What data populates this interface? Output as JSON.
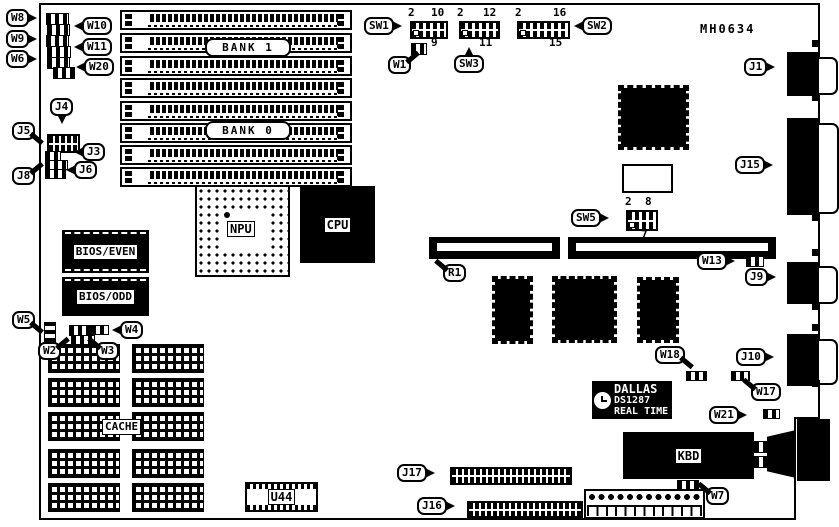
{
  "board": {
    "part_number": "MH0634",
    "ink": "#000000",
    "paper": "#ffffff"
  },
  "callouts": {
    "w8": "W8",
    "w9": "W9",
    "w6": "W6",
    "w10": "W10",
    "w11": "W11",
    "w20": "W20",
    "j4": "J4",
    "j5": "J5",
    "j3": "J3",
    "j6": "J6",
    "j8": "J8",
    "sw1": "SW1",
    "w1": "W1",
    "sw3": "SW3",
    "sw2": "SW2",
    "j1": "J1",
    "j15": "J15",
    "sw5": "SW5",
    "r1": "R1",
    "w13": "W13",
    "j9": "J9",
    "j10": "J10",
    "w18": "W18",
    "w17": "W17",
    "w21": "W21",
    "w5": "W5",
    "w2": "W2",
    "w3": "W3",
    "w4": "W4",
    "j17": "J17",
    "j16": "J16",
    "w7": "W7"
  },
  "chips": {
    "npu": "NPU",
    "cpu": "CPU",
    "bios_even": "BIOS/EVEN",
    "bios_odd": "BIOS/ODD",
    "cache": "CACHE",
    "kbd": "KBD",
    "u44": "U44"
  },
  "memory": {
    "bank1": "BANK 1",
    "bank0": "BANK 0",
    "simm_rows": 8
  },
  "rtc": {
    "brand": "DALLAS",
    "part": "DS1287",
    "tagline": "REAL TIME"
  },
  "switch_pins": {
    "sw1_first": "2",
    "sw1_top": "10",
    "sw1_bottom": "9",
    "sw3_first": "2",
    "sw3_top": "12",
    "sw3_bottom": "11",
    "sw2_first": "2",
    "sw2_top": "16",
    "sw2_bottom": "15",
    "sw5_first": "2",
    "sw5_top": "8",
    "sw5_bottom": "7"
  },
  "cache_layout": {
    "columns": 2,
    "rows": 5
  }
}
